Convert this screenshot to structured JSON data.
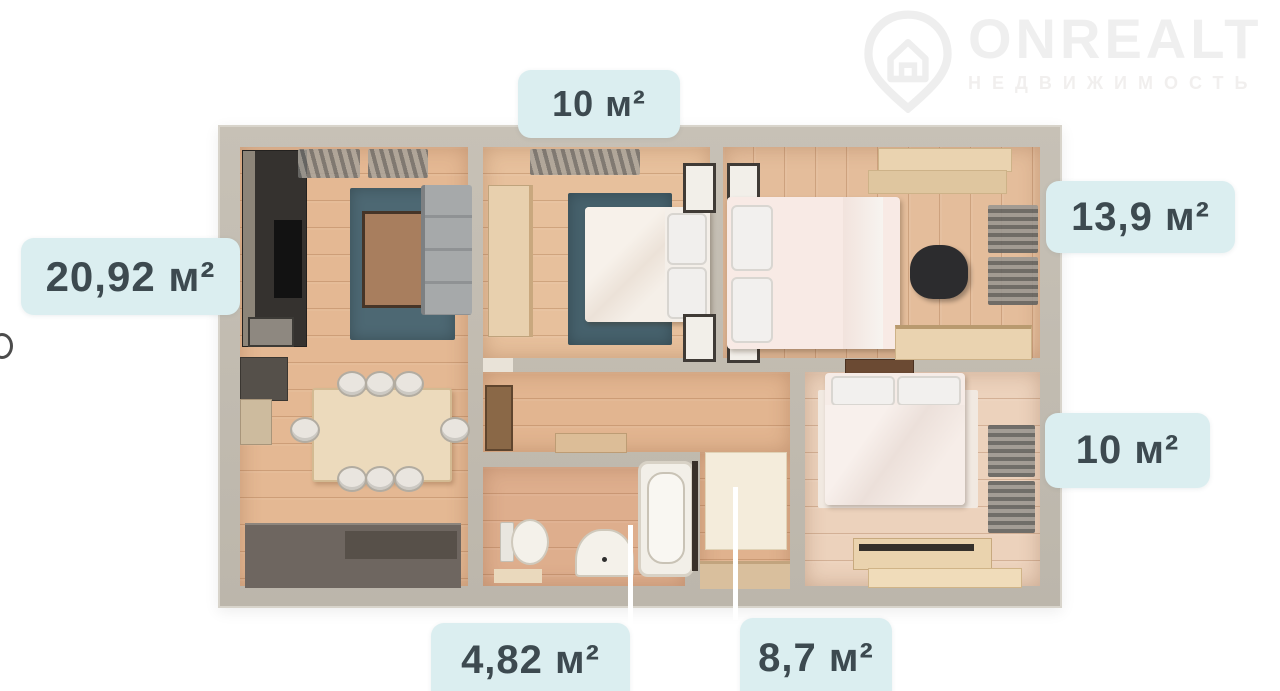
{
  "watermark": {
    "brand": "ONREALT",
    "subtitle": "НЕДВИЖИМОСТЬ",
    "icon": "house-location-pin-icon"
  },
  "floorplan": {
    "area_labels": {
      "bedroom_top": "10 м²",
      "living_room": "20,92 м²",
      "bedroom_right_top": "13,9 м²",
      "bedroom_right_bottom": "10 м²",
      "bathroom": "4,82 м²",
      "hallway": "8,7 м²"
    },
    "colors": {
      "badge_background": "#dbeef0",
      "badge_text": "#3d4a50",
      "wall": "#c1bbb0",
      "wood_floor": "#e5bd99",
      "rug_teal": "#4d6873",
      "watermark_gray": "#efefef"
    }
  }
}
